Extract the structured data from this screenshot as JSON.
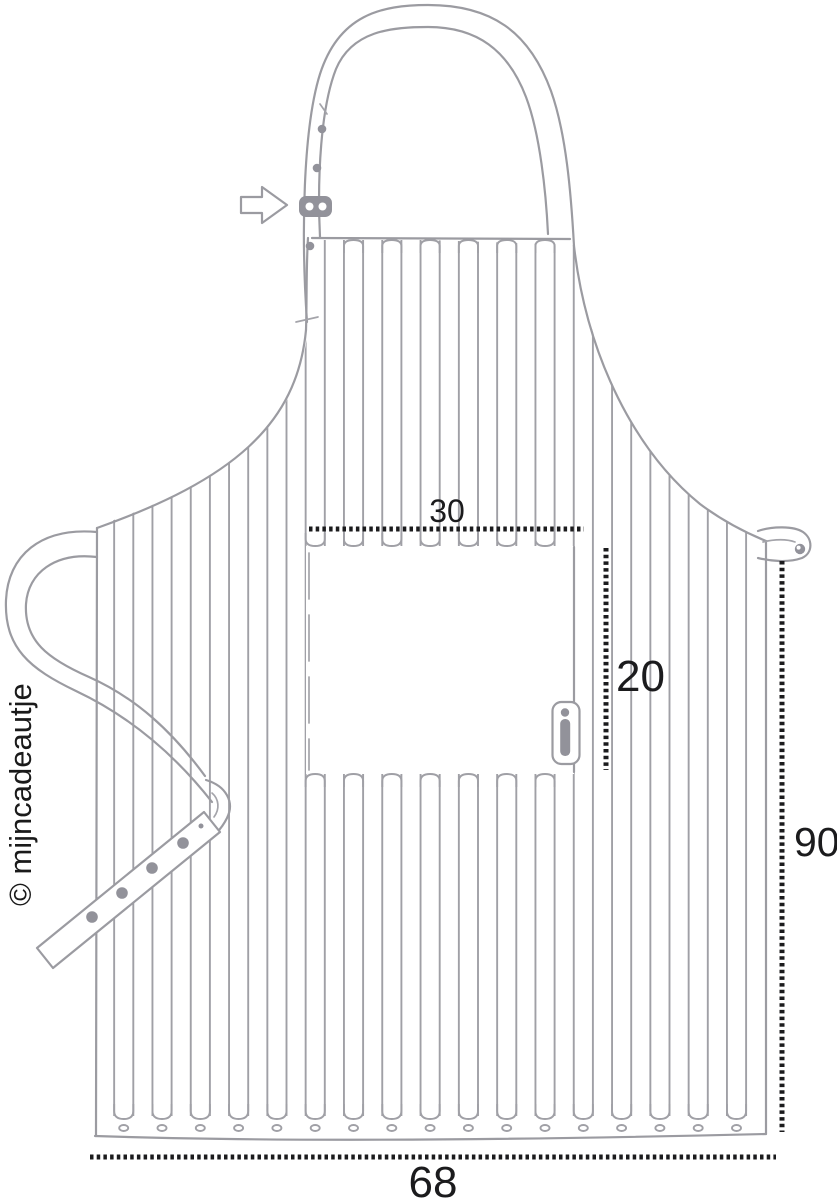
{
  "copyright": "© mijncadeautje",
  "dimensions": {
    "pocket_width": "30",
    "pocket_height": "20",
    "apron_length": "90",
    "apron_width": "68"
  },
  "icons": {
    "arrow": "right-arrow-pointer-to-neck-strap-adjuster"
  },
  "colors": {
    "line_gray": "#9b9ba1",
    "detail_gray": "#92929a",
    "ink_black": "#1b1b1d",
    "background": "#ffffff"
  }
}
